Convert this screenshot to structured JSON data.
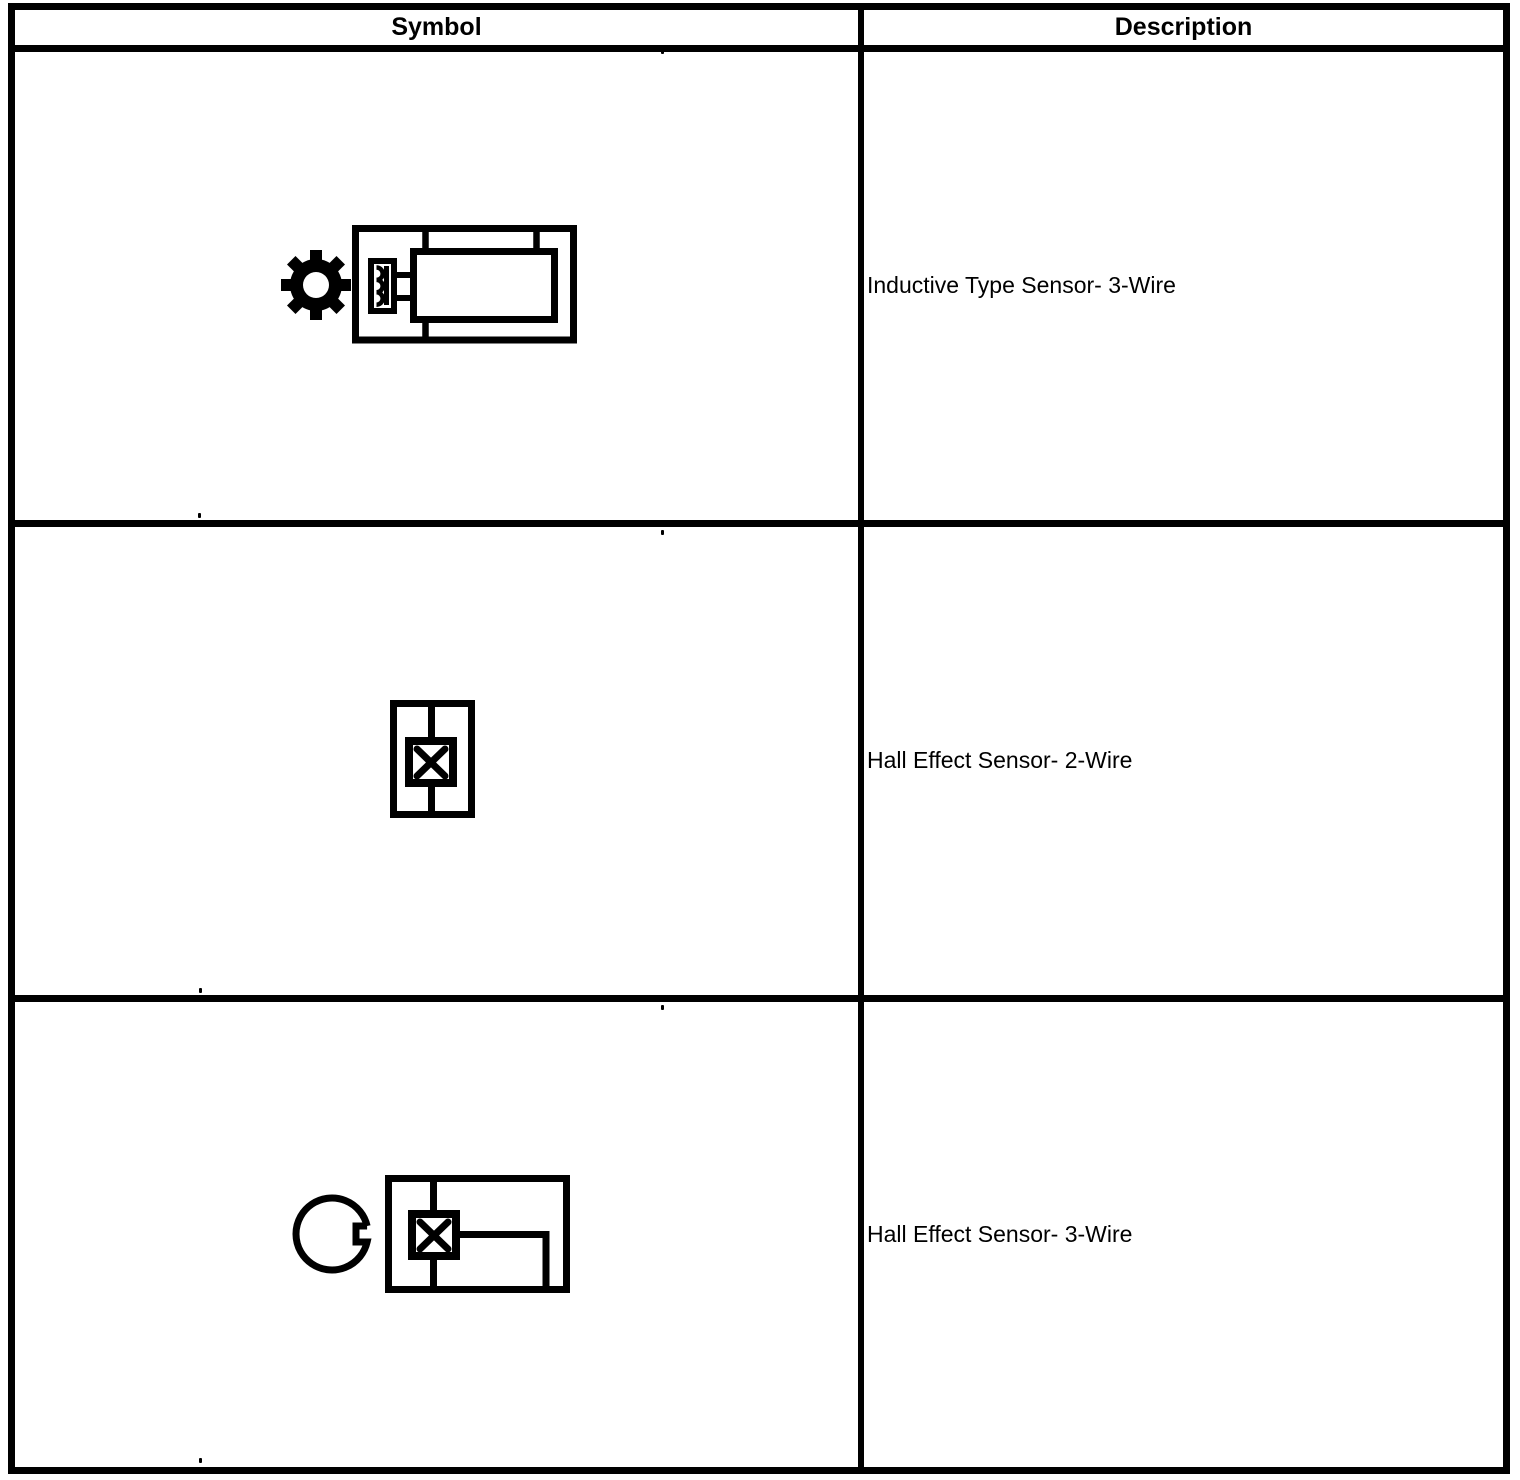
{
  "table": {
    "columns": [
      {
        "label": "Symbol"
      },
      {
        "label": "Description"
      }
    ],
    "rows": [
      {
        "symbol_icon": "gear-and-inductive-sensor-symbol",
        "description": "Inductive Type Sensor- 3-Wire"
      },
      {
        "symbol_icon": "hall-effect-sensor-2-wire-symbol",
        "description": "Hall Effect Sensor- 2-Wire"
      },
      {
        "symbol_icon": "notched-reluctor-and-hall-sensor-symbol",
        "description": "Hall Effect Sensor- 3-Wire"
      }
    ],
    "colors": {
      "line": "#000000",
      "background": "#ffffff",
      "text": "#000000"
    }
  }
}
